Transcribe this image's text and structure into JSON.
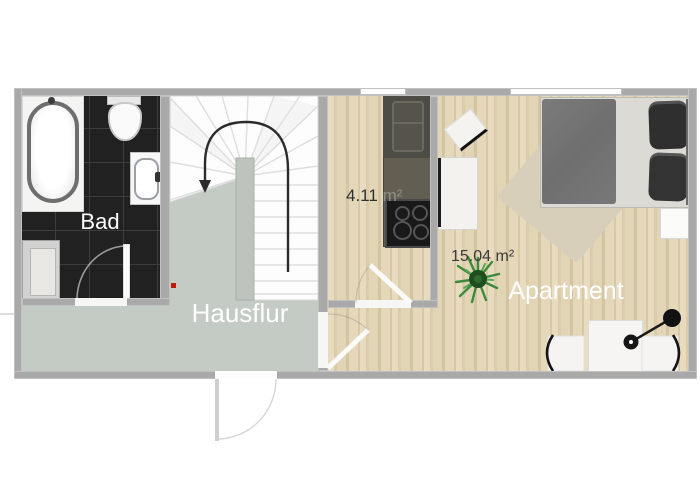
{
  "title": "Apartment floor plan",
  "colors": {
    "background": "#ffffff",
    "wall": "#a9a9a9",
    "hallway_floor": "#c4cac4",
    "wood_floor": "#e2d5b6",
    "bath_tile": "#212121",
    "counter_upper": "#4e4d45",
    "counter_lower": "#625f52",
    "cooktop": "#191919",
    "rug": "#d8cfba",
    "duvet": "#737373",
    "bed_frame": "#dcdad4",
    "pillow": "#2f2f2f",
    "plant_green": "#3c8a3c",
    "red_marker": "#c21807",
    "label_light": "#ffffff",
    "label_dark": "#3a3a3a",
    "unit_gray": "#8e8e86"
  },
  "rooms": {
    "bathroom": {
      "label": "Bad"
    },
    "hallway": {
      "label": "Hausflur"
    },
    "kitchen": {
      "area_value": "4.11",
      "area_unit": "m²"
    },
    "living": {
      "label": "Apartment",
      "area": "15.04 m²"
    }
  }
}
